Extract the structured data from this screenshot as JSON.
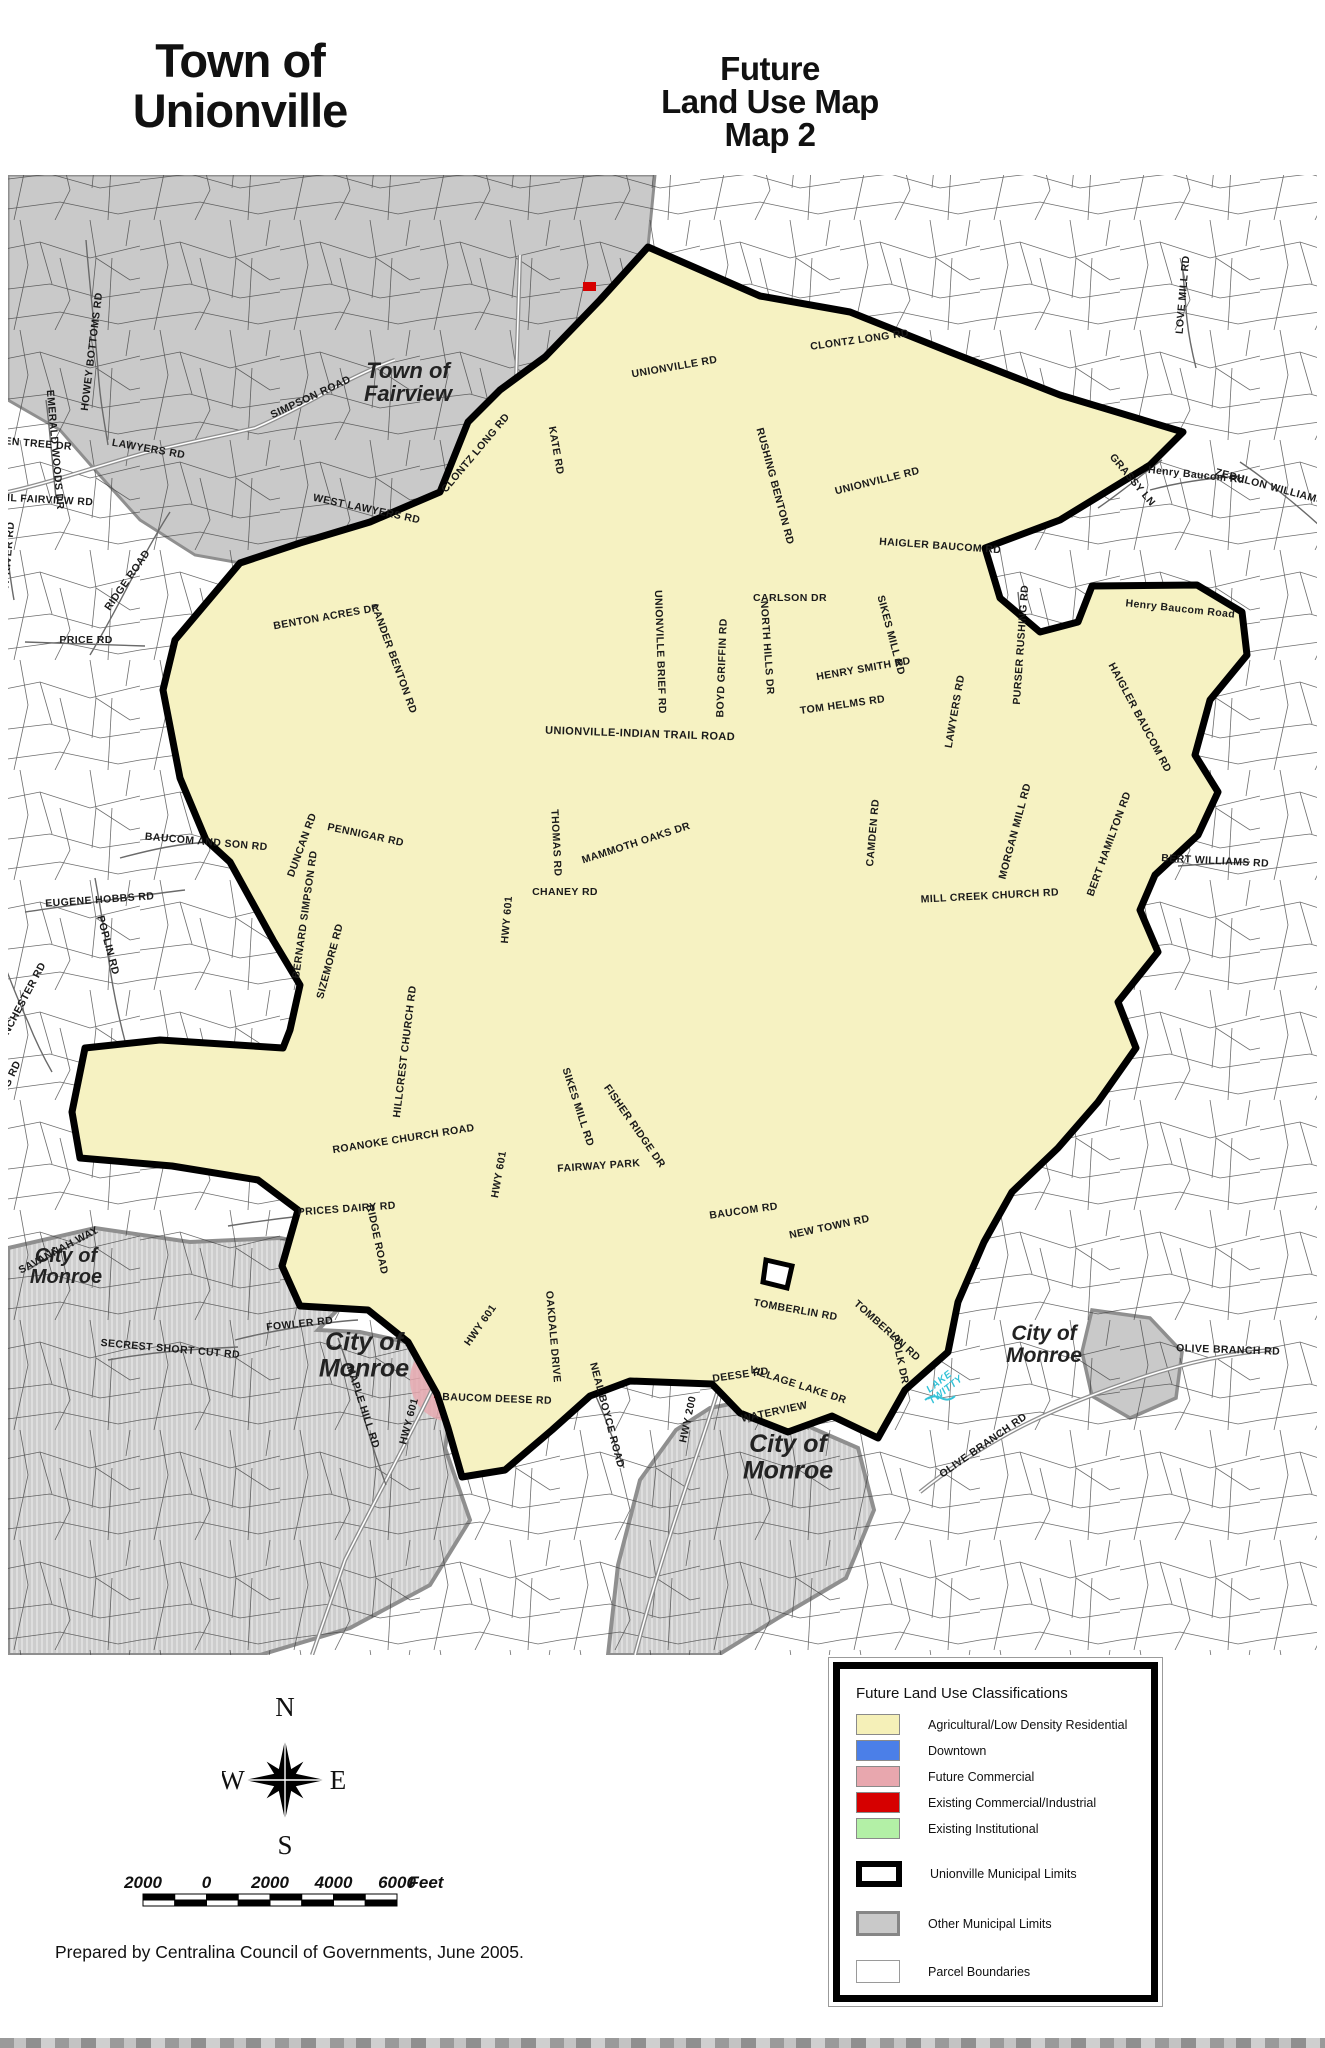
{
  "page": {
    "title_line1": "Town of",
    "title_line2": "Unionville",
    "map_title_line1": "Future",
    "map_title_line2": "Land Use Map",
    "map_title_line3": "Map 2",
    "credit": "Prepared by Centralina Council of Governments, June 2005."
  },
  "colors": {
    "agricultural": "#F5F0B8",
    "downtown": "#4B7FE8",
    "future_commercial": "#E8A7AE",
    "existing_commercial": "#D60000",
    "existing_institutional": "#B3F0A6",
    "other_municipal": "#C9C9C9",
    "unionville_fill": "#F6F2C2"
  },
  "legend": {
    "title": "Future Land Use Classifications",
    "landuse_items": [
      {
        "key": "agricultural",
        "label": "Agricultural/Low Density Residential"
      },
      {
        "key": "downtown",
        "label": "Downtown"
      },
      {
        "key": "future_commercial",
        "label": "Future Commercial"
      },
      {
        "key": "existing_commercial",
        "label": "Existing Commercial/Industrial"
      },
      {
        "key": "existing_institutional",
        "label": "Existing Institutional"
      }
    ],
    "boundary_items": [
      {
        "key": "unionville",
        "label": "Unionville Municipal Limits"
      },
      {
        "key": "other",
        "label": "Other Municipal Limits"
      },
      {
        "key": "parcel",
        "label": "Parcel Boundaries"
      }
    ]
  },
  "compass": {
    "n": "N",
    "s": "S",
    "e": "E",
    "w": "W"
  },
  "scale_bar": {
    "labels": [
      "2000",
      "0",
      "2000",
      "4000",
      "6000"
    ],
    "unit": "Feet"
  },
  "map": {
    "place_labels": [
      {
        "t": "Town of\nFairview",
        "x": 408,
        "y": 378,
        "s": 22
      },
      {
        "t": "City of\nMonroe",
        "x": 66,
        "y": 1262,
        "s": 20
      },
      {
        "t": "City of\nMonroe",
        "x": 364,
        "y": 1350,
        "s": 25
      },
      {
        "t": "City of\nMonroe",
        "x": 788,
        "y": 1452,
        "s": 25
      },
      {
        "t": "City of\nMonroe",
        "x": 1044,
        "y": 1340,
        "s": 21
      }
    ],
    "water_labels": [
      {
        "t": "LAKE\nTWITTY",
        "x": 941,
        "y": 1384,
        "r": -38,
        "s": 10
      }
    ],
    "road_labels": [
      {
        "t": "HOWEY BOTTOMS RD",
        "x": 95,
        "y": 352,
        "r": -83
      },
      {
        "t": "SIMPSON ROAD",
        "x": 312,
        "y": 400,
        "r": -25
      },
      {
        "t": "LAWYERS RD",
        "x": 148,
        "y": 452,
        "r": 10
      },
      {
        "t": "AIL FAIRVIEW RD",
        "x": 46,
        "y": 503,
        "r": 3
      },
      {
        "t": "GREEN TREE DR",
        "x": 26,
        "y": 446,
        "r": 5
      },
      {
        "t": "EMERALD WOODS DR",
        "x": 52,
        "y": 450,
        "r": 85
      },
      {
        "t": "RIDGE ROAD",
        "x": 130,
        "y": 582,
        "r": -55
      },
      {
        "t": "PRICE RD",
        "x": 86,
        "y": 643,
        "r": 0
      },
      {
        "t": "ROCKY RIVER RD",
        "x": 10,
        "y": 570,
        "r": -85
      },
      {
        "t": "WEST LAWYERS RD",
        "x": 366,
        "y": 512,
        "r": 12
      },
      {
        "t": "CLONTZ LONG RD",
        "x": 478,
        "y": 455,
        "r": -50
      },
      {
        "t": "CLONTZ LONG RD",
        "x": 860,
        "y": 343,
        "r": -8
      },
      {
        "t": "KATE RD",
        "x": 553,
        "y": 451,
        "r": 80
      },
      {
        "t": "UNIONVILLE RD",
        "x": 675,
        "y": 370,
        "r": -10
      },
      {
        "t": "UNIONVILLE RD",
        "x": 878,
        "y": 484,
        "r": -14
      },
      {
        "t": "RUSHING BENTON RD",
        "x": 772,
        "y": 487,
        "r": 75
      },
      {
        "t": "LOVE MILL RD",
        "x": 1186,
        "y": 295,
        "r": -85
      },
      {
        "t": "ZEBULON WILLIAMS RD",
        "x": 1278,
        "y": 492,
        "r": 15
      },
      {
        "t": "GRASSY LN",
        "x": 1130,
        "y": 482,
        "r": 50
      },
      {
        "t": "Henry Baucom Rd",
        "x": 1196,
        "y": 478,
        "r": 6
      },
      {
        "t": "HAIGLER BAUCOM RD",
        "x": 940,
        "y": 549,
        "r": 4
      },
      {
        "t": "CARLSON DR",
        "x": 790,
        "y": 601,
        "r": 0
      },
      {
        "t": "HENRY SMITH RD",
        "x": 864,
        "y": 672,
        "r": -10
      },
      {
        "t": "SIKES MILL RD",
        "x": 888,
        "y": 636,
        "r": 75
      },
      {
        "t": "TOM HELMS RD",
        "x": 843,
        "y": 708,
        "r": -8
      },
      {
        "t": "BOYD GRIFFIN RD",
        "x": 725,
        "y": 668,
        "r": -88
      },
      {
        "t": "NORTH HILLS DR",
        "x": 764,
        "y": 648,
        "r": 86
      },
      {
        "t": "UNIONVILLE BRIEF RD",
        "x": 657,
        "y": 652,
        "r": 88
      },
      {
        "t": "UNIONVILLE-INDIAN TRAIL ROAD",
        "x": 640,
        "y": 737,
        "r": 2,
        "s": 11
      },
      {
        "t": "Henry Baucom Road",
        "x": 1180,
        "y": 612,
        "r": 6
      },
      {
        "t": "HAIGLER BAUCOM RD",
        "x": 1137,
        "y": 719,
        "r": 62
      },
      {
        "t": "PURSER RUSHING RD",
        "x": 1024,
        "y": 645,
        "r": -86
      },
      {
        "t": "LAWYERS RD",
        "x": 958,
        "y": 712,
        "r": -80
      },
      {
        "t": "CAMDEN RD",
        "x": 876,
        "y": 833,
        "r": -85
      },
      {
        "t": "MILL CREEK CHURCH RD",
        "x": 990,
        "y": 899,
        "r": -3
      },
      {
        "t": "BENTON ACRES DR",
        "x": 327,
        "y": 620,
        "r": -10
      },
      {
        "t": "LANDER BENTON RD",
        "x": 391,
        "y": 660,
        "r": 70
      },
      {
        "t": "PENNIGAR RD",
        "x": 365,
        "y": 838,
        "r": 12
      },
      {
        "t": "DUNCAN RD",
        "x": 305,
        "y": 846,
        "r": -70
      },
      {
        "t": "BAUCOM AND SON RD",
        "x": 206,
        "y": 845,
        "r": 5
      },
      {
        "t": "EUGENE HOBBS RD",
        "x": 100,
        "y": 903,
        "r": -4
      },
      {
        "t": "POPLIN RD",
        "x": 105,
        "y": 946,
        "r": 75
      },
      {
        "t": "WINCHESTER RD",
        "x": 24,
        "y": 1006,
        "r": -62
      },
      {
        "t": "LONG RD",
        "x": 10,
        "y": 1086,
        "r": -65
      },
      {
        "t": "BERNARD SIMPSON RD",
        "x": 308,
        "y": 915,
        "r": -82
      },
      {
        "t": "SIZEMORE RD",
        "x": 333,
        "y": 962,
        "r": -75
      },
      {
        "t": "HWY 601",
        "x": 510,
        "y": 920,
        "r": -85
      },
      {
        "t": "HWY 601",
        "x": 502,
        "y": 1175,
        "r": -80
      },
      {
        "t": "HWY 601",
        "x": 483,
        "y": 1327,
        "r": -55
      },
      {
        "t": "HWY 601",
        "x": 412,
        "y": 1422,
        "r": -75
      },
      {
        "t": "HWY 200",
        "x": 691,
        "y": 1420,
        "r": -78
      },
      {
        "t": "THOMAS RD",
        "x": 553,
        "y": 843,
        "r": 87
      },
      {
        "t": "MAMMOTH OAKS DR",
        "x": 637,
        "y": 846,
        "r": -18
      },
      {
        "t": "CHANEY RD",
        "x": 565,
        "y": 895,
        "r": 0
      },
      {
        "t": "HILLCREST CHURCH RD",
        "x": 408,
        "y": 1052,
        "r": -83
      },
      {
        "t": "ROANOKE CHURCH ROAD",
        "x": 404,
        "y": 1142,
        "r": -9
      },
      {
        "t": "PRICES DAIRY RD",
        "x": 347,
        "y": 1212,
        "r": -4
      },
      {
        "t": "RIDGE ROAD",
        "x": 374,
        "y": 1240,
        "r": 78
      },
      {
        "t": "SIKES MILL RD",
        "x": 575,
        "y": 1108,
        "r": 72
      },
      {
        "t": "FAIRWAY PARK",
        "x": 599,
        "y": 1169,
        "r": -4
      },
      {
        "t": "FISHER RIDGE DR",
        "x": 632,
        "y": 1128,
        "r": 55
      },
      {
        "t": "FOWLER RD",
        "x": 300,
        "y": 1327,
        "r": -6
      },
      {
        "t": "MAPLE HILL RD",
        "x": 360,
        "y": 1408,
        "r": 72
      },
      {
        "t": "BAUCOM DEESE RD",
        "x": 497,
        "y": 1402,
        "r": 2
      },
      {
        "t": "OAKDALE DRIVE",
        "x": 550,
        "y": 1337,
        "r": 85
      },
      {
        "t": "NEAL BOYCE ROAD",
        "x": 604,
        "y": 1416,
        "r": 75
      },
      {
        "t": "BAUCOM RD",
        "x": 744,
        "y": 1214,
        "r": -8
      },
      {
        "t": "NEW TOWN RD",
        "x": 830,
        "y": 1230,
        "r": -12
      },
      {
        "t": "TOMBERLIN RD",
        "x": 795,
        "y": 1313,
        "r": 10
      },
      {
        "t": "TOMBERLIN RD",
        "x": 885,
        "y": 1333,
        "r": 42
      },
      {
        "t": "VILLAGE LAKE DR",
        "x": 797,
        "y": 1388,
        "r": 18
      },
      {
        "t": "DEESE RD",
        "x": 741,
        "y": 1378,
        "r": -8
      },
      {
        "t": "POLK DR",
        "x": 897,
        "y": 1360,
        "r": 78
      },
      {
        "t": "WATERVIEW",
        "x": 775,
        "y": 1415,
        "r": -12
      },
      {
        "t": "OLIVE BRANCH RD",
        "x": 985,
        "y": 1448,
        "r": -35
      },
      {
        "t": "OLIVE BRANCH RD",
        "x": 1228,
        "y": 1353,
        "r": 2
      },
      {
        "t": "MORGAN MILL RD",
        "x": 1018,
        "y": 832,
        "r": -75
      },
      {
        "t": "BERT HAMILTON RD",
        "x": 1112,
        "y": 845,
        "r": -70
      },
      {
        "t": "BERT WILLIAMS RD",
        "x": 1215,
        "y": 864,
        "r": 3
      },
      {
        "t": "SECREST SHORT CUT RD",
        "x": 170,
        "y": 1352,
        "r": 5
      },
      {
        "t": "SAVANNAH WAY",
        "x": 60,
        "y": 1253,
        "r": -28
      }
    ]
  }
}
